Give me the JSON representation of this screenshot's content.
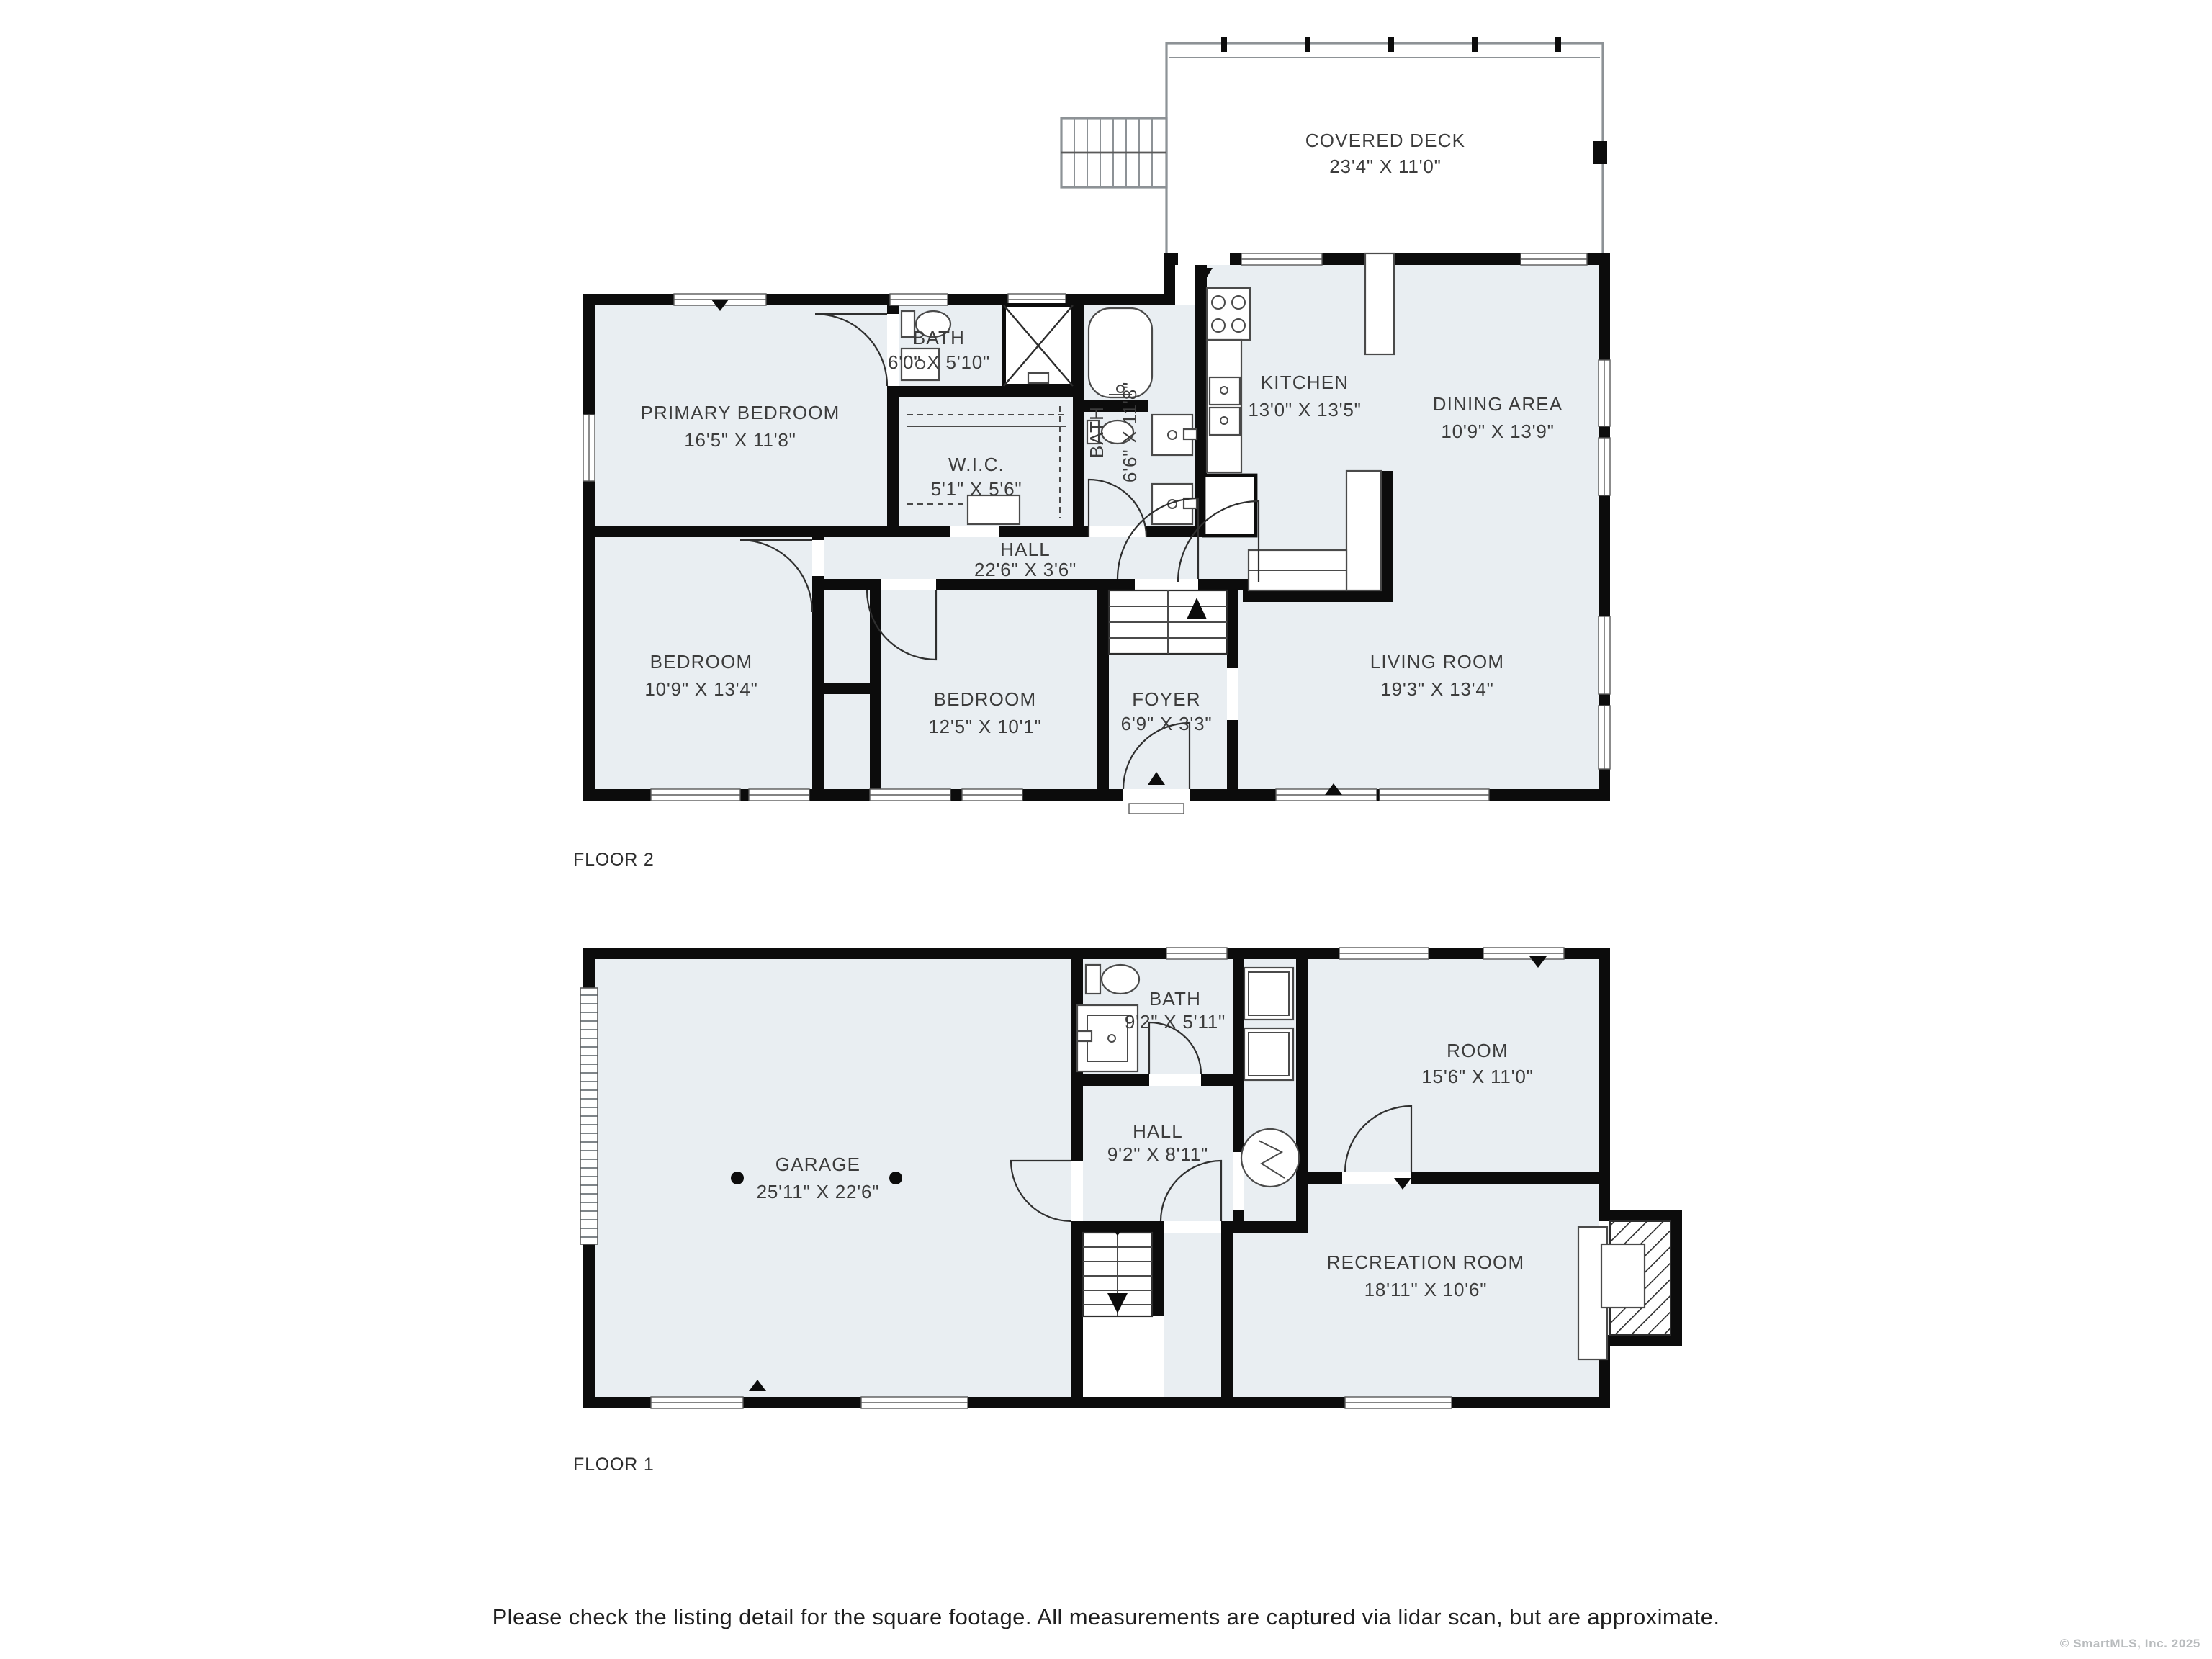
{
  "page": {
    "background": "#ffffff"
  },
  "colors": {
    "room_fill": "#e9eef2",
    "wall": "#0c0c0c",
    "label_text": "#3c3c3c",
    "fixture_stroke": "#4a4a4a",
    "deck_outline": "#8d9296",
    "copyright_text": "#b9bcbe"
  },
  "floors": [
    {
      "label": "FLOOR 2",
      "rooms": [
        {
          "id": "covered-deck",
          "name": "COVERED DECK",
          "dims": "23'4\" X 11'0\""
        },
        {
          "id": "primary-bedroom",
          "name": "PRIMARY BEDROOM",
          "dims": "16'5\" X 11'8\""
        },
        {
          "id": "bath",
          "name": "BATH",
          "dims": "6'0\" X 5'10\""
        },
        {
          "id": "walk-in-closet",
          "name": "W.I.C.",
          "dims": "5'1\" X 5'6\""
        },
        {
          "id": "bath-2",
          "name": "BATH",
          "dims": "6'6\" X 11'8\""
        },
        {
          "id": "kitchen",
          "name": "KITCHEN",
          "dims": "13'0\" X 13'5\""
        },
        {
          "id": "dining-area",
          "name": "DINING AREA",
          "dims": "10'9\" X 13'9\""
        },
        {
          "id": "hall",
          "name": "HALL",
          "dims": "22'6\" X 3'6\""
        },
        {
          "id": "bedroom-left",
          "name": "BEDROOM",
          "dims": "10'9\" X 13'4\""
        },
        {
          "id": "bedroom-middle",
          "name": "BEDROOM",
          "dims": "12'5\" X 10'1\""
        },
        {
          "id": "foyer",
          "name": "FOYER",
          "dims": "6'9\" X 3'3\""
        },
        {
          "id": "living-room",
          "name": "LIVING ROOM",
          "dims": "19'3\" X 13'4\""
        }
      ]
    },
    {
      "label": "FLOOR 1",
      "rooms": [
        {
          "id": "garage",
          "name": "GARAGE",
          "dims": "25'11\" X 22'6\""
        },
        {
          "id": "bath-floor1",
          "name": "BATH",
          "dims": "9'2\" X 5'11\""
        },
        {
          "id": "hall-floor1",
          "name": "HALL",
          "dims": "9'2\" X 8'11\""
        },
        {
          "id": "room",
          "name": "ROOM",
          "dims": "15'6\" X 11'0\""
        },
        {
          "id": "recreation-room",
          "name": "RECREATION ROOM",
          "dims": "18'11\" X 10'6\""
        }
      ]
    }
  ],
  "footer": {
    "disclaimer": "Please check the listing detail for the square footage. All measurements are captured via lidar scan, but are approximate.",
    "copyright": "© SmartMLS, Inc.  2025"
  }
}
